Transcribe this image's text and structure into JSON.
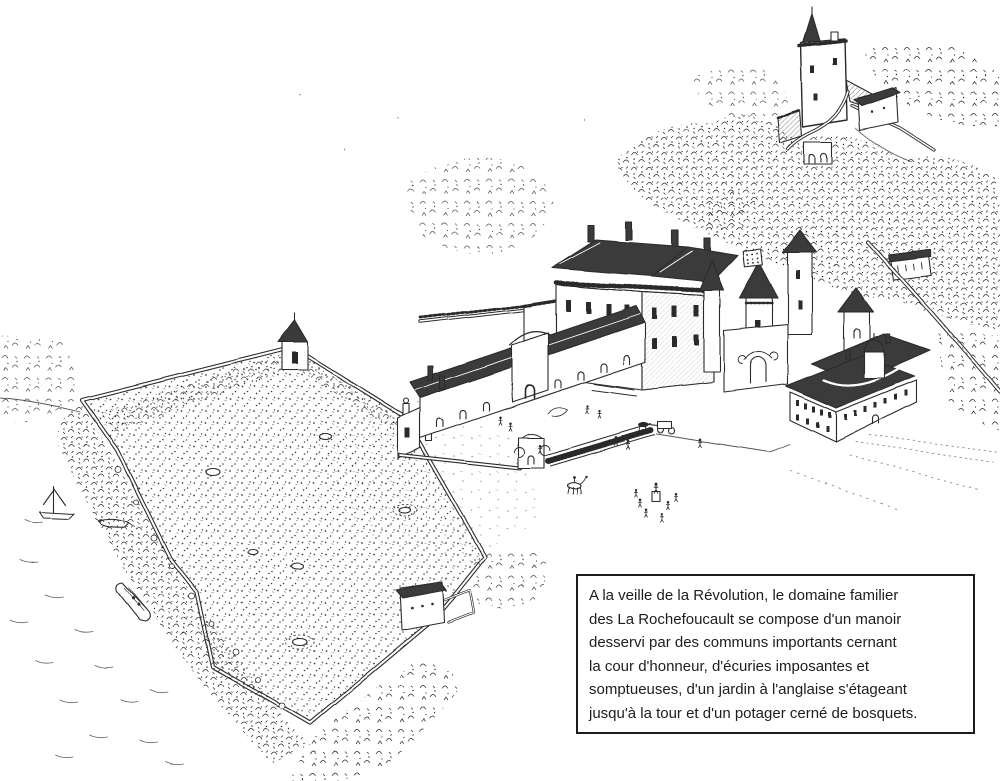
{
  "illustration": {
    "title": "bird's-eye engraving of the La Rochefoucault domain",
    "ink_color": "#2c2c2c",
    "roof_color": "#3a3a3a",
    "paper_color": "#ffffff"
  },
  "caption": {
    "lines": [
      "A la veille de la Révolution, le domaine familier",
      "des La Rochefoucault se compose d'un manoir",
      "desservi par des communs importants cernant",
      "la cour d'honneur, d'écuries imposantes et",
      "somptueuses, d'un jardin à l'anglaise s'étageant",
      "jusqu'à la tour et d'un potager cerné de bosquets."
    ]
  }
}
